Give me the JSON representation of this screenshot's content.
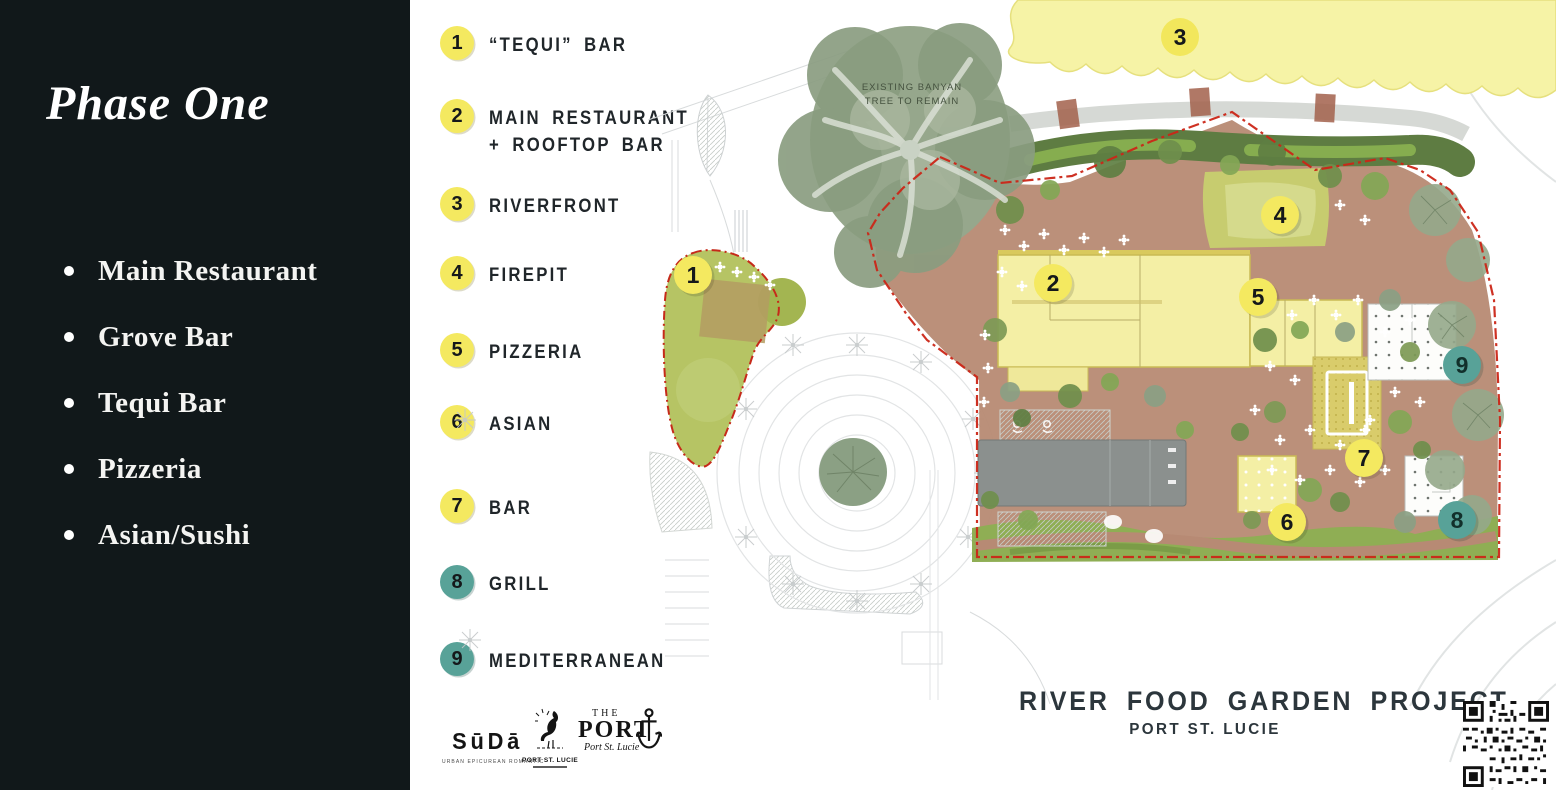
{
  "sidebar": {
    "title": "Phase One",
    "bullets": [
      "Main Restaurant",
      "Grove Bar",
      "Tequi Bar",
      "Pizzeria",
      "Asian/Sushi"
    ]
  },
  "legend": {
    "items": [
      {
        "num": "1",
        "label": "“TEQUI” BAR",
        "color": "yellow"
      },
      {
        "num": "2",
        "label": "MAIN RESTAURANT",
        "label2": "+ ROOFTOP BAR",
        "color": "yellow"
      },
      {
        "num": "3",
        "label": "RIVERFRONT",
        "color": "yellow"
      },
      {
        "num": "4",
        "label": "FIREPIT",
        "color": "yellow"
      },
      {
        "num": "5",
        "label": "PIZZERIA",
        "color": "yellow"
      },
      {
        "num": "6",
        "label": "ASIAN",
        "color": "yellow"
      },
      {
        "num": "7",
        "label": "BAR",
        "color": "yellow"
      },
      {
        "num": "8",
        "label": "GRILL",
        "color": "teal"
      },
      {
        "num": "9",
        "label": "MEDITERRANEAN",
        "color": "teal"
      }
    ]
  },
  "map": {
    "markers": [
      {
        "num": "1"
      },
      {
        "num": "2"
      },
      {
        "num": "3"
      },
      {
        "num": "4"
      },
      {
        "num": "5"
      },
      {
        "num": "6"
      },
      {
        "num": "7"
      },
      {
        "num": "8"
      },
      {
        "num": "9"
      }
    ],
    "banyan_note": [
      "EXISTING BANYAN",
      "TREE TO REMAIN"
    ]
  },
  "footer": {
    "title": "RIVER FOOD GARDEN PROJECT",
    "subtitle": "PORT ST. LUCIE"
  },
  "logos": {
    "suda": {
      "name": "SūDā",
      "tagline": "URBAN EPICUREAN ROMANTIC"
    },
    "port_city": {
      "name": "PORT ST. LUCIE"
    },
    "the_port": {
      "line1": "THE",
      "line2": "PORT",
      "script": "Port St. Lucie"
    }
  },
  "colors": {
    "sidebar_bg": "#11181a",
    "marker_yellow": "#f4e960",
    "marker_teal": "#58a298",
    "boundary_red": "#cb2617",
    "riverfront_yellow": "#f6f3a6",
    "building_yellow": "#f4efa5",
    "brick_plaza": "#b88b75",
    "lawn_green": "#8fae54"
  }
}
